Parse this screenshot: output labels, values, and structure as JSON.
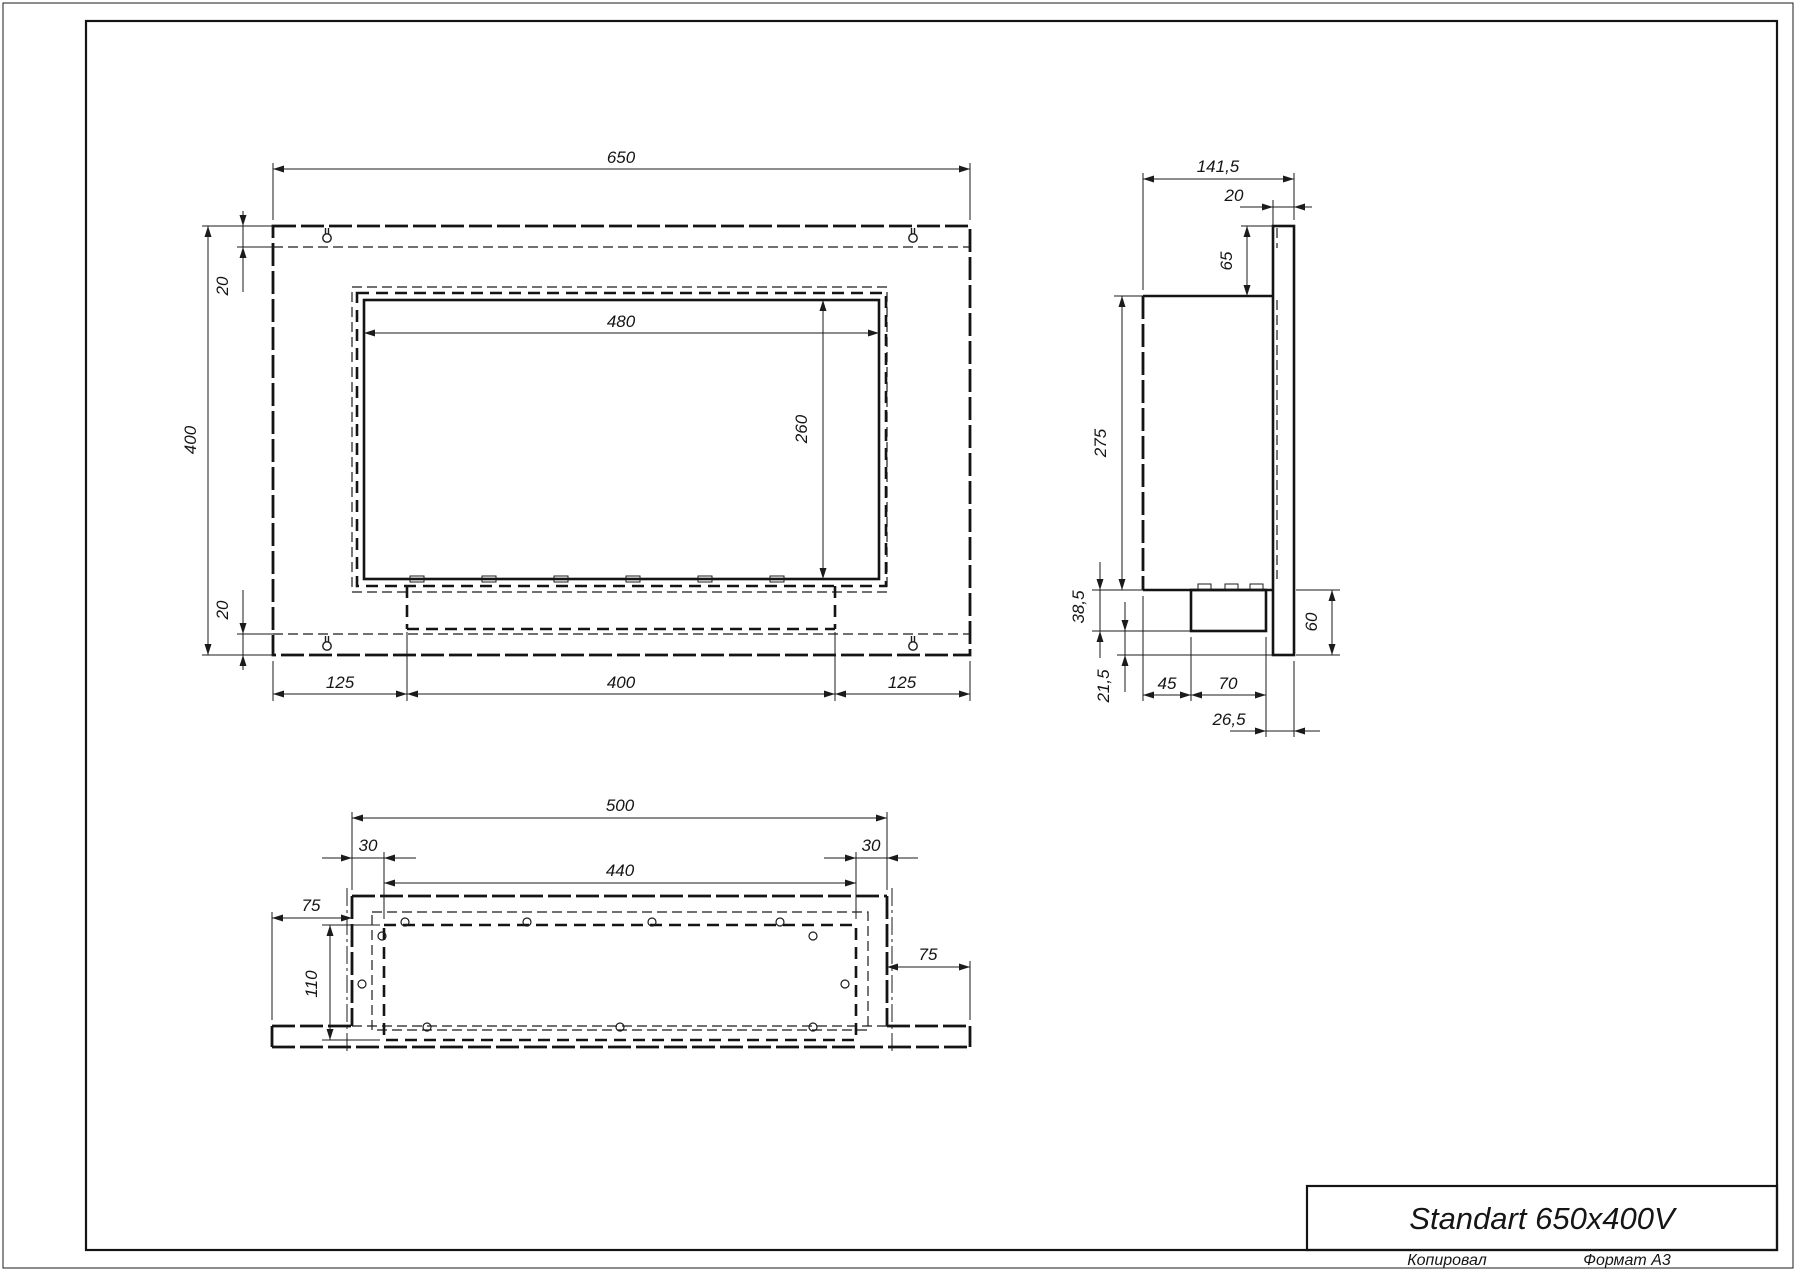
{
  "title_block": {
    "title": "Standart 650x400V"
  },
  "footer": {
    "copied_label": "Копировал",
    "format_label": "Формат A3"
  },
  "front_view": {
    "width": "650",
    "height": "400",
    "top_margin": "20",
    "bottom_margin": "20",
    "opening_width": "480",
    "opening_height": "260",
    "bottom_left": "125",
    "bottom_center": "400",
    "bottom_right": "125"
  },
  "side_view": {
    "total_depth": "141,5",
    "flange_depth": "20",
    "top_offset": "65",
    "body_height": "275",
    "tray_height": "38,5",
    "tray_bottom_offset": "21,5",
    "rear_offset": "45",
    "tray_width": "70",
    "front_offset": "26,5",
    "bottom_offset": "60"
  },
  "bottom_view": {
    "body_width": "500",
    "left_margin": "30",
    "opening_width": "440",
    "right_margin": "30",
    "left_overhang": "75",
    "opening_depth": "110",
    "right_overhang": "75"
  }
}
